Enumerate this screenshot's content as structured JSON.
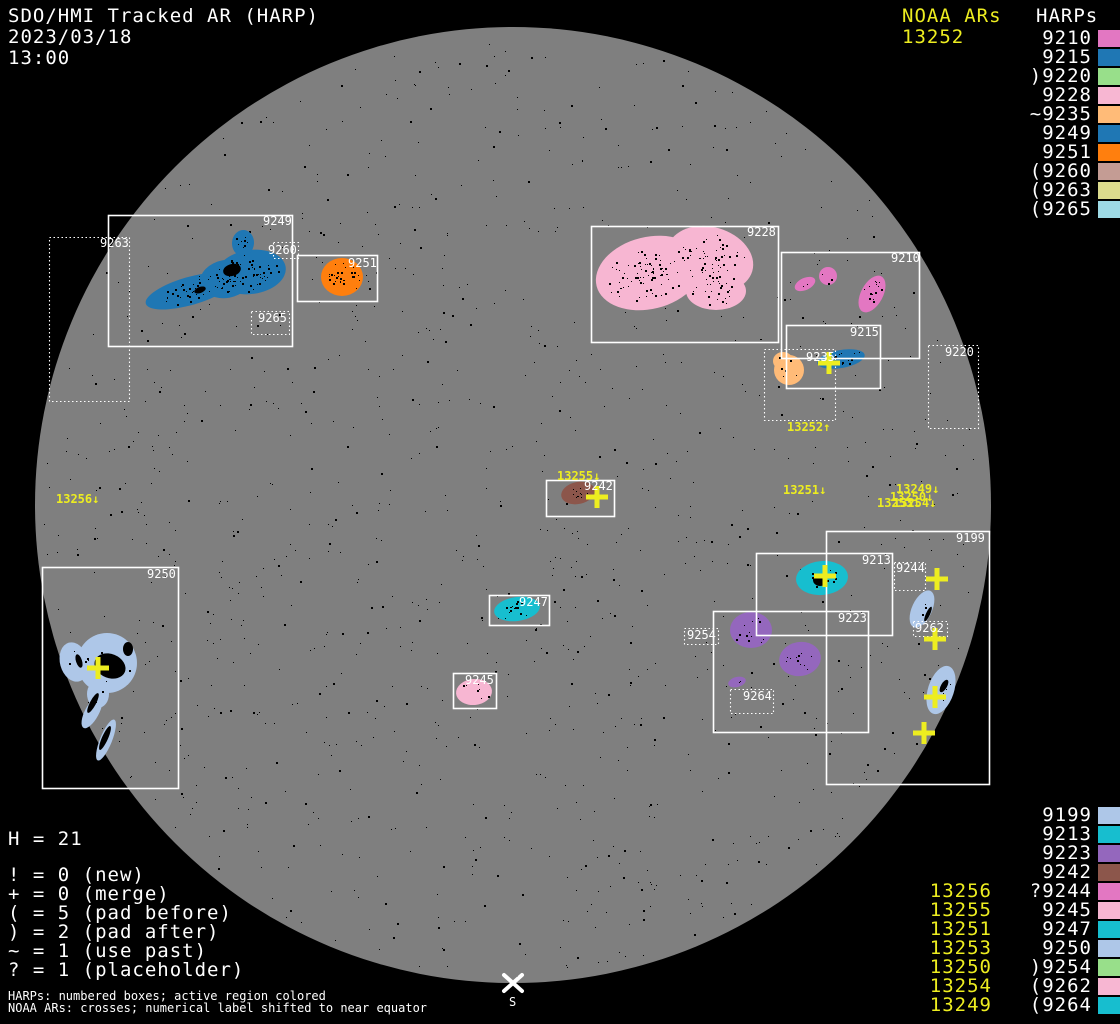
{
  "chart_data": {
    "type": "scatter",
    "title": "SDO/HMI Tracked AR (HARP)",
    "date": "2023/03/18",
    "time": "13:00",
    "noaa_header": "NOAA ARs",
    "noaa_current": "13252",
    "harps_header": "HARPs",
    "colors": {
      "background": "#000000",
      "disk": "#7f7f7f",
      "box_line": "#ffffff",
      "yellow": "#eded20"
    },
    "disk": {
      "cx": 513,
      "cy": 505,
      "r": 478
    },
    "legend_top": [
      {
        "text": "9210",
        "color": "#e377c2"
      },
      {
        "text": "9215",
        "color": "#1f77b4"
      },
      {
        "text": ")9220",
        "color": "#98df8a"
      },
      {
        "text": "9228",
        "color": "#f7b6d2"
      },
      {
        "text": "~9235",
        "color": "#ffbb78"
      },
      {
        "text": "9249",
        "color": "#1f77b4"
      },
      {
        "text": "9251",
        "color": "#ff7f0e"
      },
      {
        "text": "(9260",
        "color": "#c49c94"
      },
      {
        "text": "(9263",
        "color": "#dbdb8d"
      },
      {
        "text": "(9265",
        "color": "#9edae5"
      }
    ],
    "legend_bottom": [
      {
        "text": "9199",
        "color": "#aec7e8"
      },
      {
        "text": "9213",
        "color": "#17becf"
      },
      {
        "text": "9223",
        "color": "#9467bd"
      },
      {
        "text": "9242",
        "color": "#8c564b"
      },
      {
        "text": "?9244",
        "color": "#e377c2"
      },
      {
        "text": "9245",
        "color": "#f7b6d2"
      },
      {
        "text": "9247",
        "color": "#17becf"
      },
      {
        "text": "9250",
        "color": "#aec7e8"
      },
      {
        "text": ")9254",
        "color": "#98df8a"
      },
      {
        "text": "(9262",
        "color": "#f7b6d2"
      },
      {
        "text": "(9264",
        "color": "#17becf"
      }
    ],
    "noaa_bottom": [
      "13256",
      "13255",
      "13251",
      "13253",
      "13250",
      "13254",
      "13249"
    ],
    "stats": {
      "header": "H = 21",
      "lines": [
        "! = 0 (new)",
        "+ = 0 (merge)",
        "( = 5 (pad before)",
        ") = 2 (pad after)",
        "~ = 1 (use past)",
        "? = 1 (placeholder)"
      ]
    },
    "footnotes": [
      "HARPs: numbered boxes; active region colored",
      "NOAA ARs: crosses; numerical label shifted to near equator"
    ],
    "south_marker": {
      "symbol": "X",
      "label": "S",
      "x": 513,
      "y": 983
    },
    "boxes": [
      {
        "id": "9249",
        "x": 108,
        "y": 215,
        "w": 184,
        "h": 131,
        "style": "solid",
        "lx": 263,
        "ly": 215
      },
      {
        "id": "9263",
        "x": 49,
        "y": 237,
        "w": 80,
        "h": 164,
        "style": "dotted",
        "lx": 100,
        "ly": 237
      },
      {
        "id": "9260",
        "x": 273,
        "y": 242,
        "w": 25,
        "h": 16,
        "style": "dotted",
        "lx": 268,
        "ly": 244
      },
      {
        "id": "9251",
        "x": 297,
        "y": 255,
        "w": 80,
        "h": 46,
        "style": "solid",
        "lx": 348,
        "ly": 257
      },
      {
        "id": "9265",
        "x": 251,
        "y": 311,
        "w": 38,
        "h": 23,
        "style": "dotted",
        "lx": 258,
        "ly": 312
      },
      {
        "id": "9228",
        "x": 591,
        "y": 226,
        "w": 187,
        "h": 116,
        "style": "solid",
        "lx": 747,
        "ly": 226
      },
      {
        "id": "9210",
        "x": 781,
        "y": 252,
        "w": 138,
        "h": 106,
        "style": "solid",
        "lx": 891,
        "ly": 252
      },
      {
        "id": "9215",
        "x": 786,
        "y": 325,
        "w": 94,
        "h": 63,
        "style": "solid",
        "lx": 850,
        "ly": 326
      },
      {
        "id": "9235",
        "x": 764,
        "y": 349,
        "w": 71,
        "h": 71,
        "style": "dotted",
        "lx": 806,
        "ly": 351
      },
      {
        "id": "9220",
        "x": 928,
        "y": 345,
        "w": 50,
        "h": 83,
        "style": "dotted",
        "lx": 945,
        "ly": 346
      },
      {
        "id": "9242",
        "x": 546,
        "y": 480,
        "w": 68,
        "h": 36,
        "style": "solid",
        "lx": 584,
        "ly": 480
      },
      {
        "id": "9213",
        "x": 756,
        "y": 553,
        "w": 136,
        "h": 82,
        "style": "solid",
        "lx": 862,
        "ly": 554
      },
      {
        "id": "9244",
        "x": 894,
        "y": 562,
        "w": 31,
        "h": 28,
        "style": "dotted",
        "lx": 896,
        "ly": 562
      },
      {
        "id": "9262",
        "x": 913,
        "y": 621,
        "w": 34,
        "h": 15,
        "style": "dotted",
        "lx": 915,
        "ly": 622
      },
      {
        "id": "9223",
        "x": 713,
        "y": 611,
        "w": 155,
        "h": 121,
        "style": "solid",
        "lx": 838,
        "ly": 612
      },
      {
        "id": "9254",
        "x": 684,
        "y": 628,
        "w": 34,
        "h": 16,
        "style": "dotted",
        "lx": 687,
        "ly": 629
      },
      {
        "id": "9264",
        "x": 730,
        "y": 689,
        "w": 43,
        "h": 24,
        "style": "dotted",
        "lx": 743,
        "ly": 690
      },
      {
        "id": "9247",
        "x": 489,
        "y": 595,
        "w": 60,
        "h": 30,
        "style": "solid",
        "lx": 519,
        "ly": 596
      },
      {
        "id": "9245",
        "x": 453,
        "y": 673,
        "w": 43,
        "h": 35,
        "style": "solid",
        "lx": 465,
        "ly": 674
      },
      {
        "id": "9250",
        "x": 42,
        "y": 567,
        "w": 136,
        "h": 221,
        "style": "solid",
        "lx": 147,
        "ly": 568
      },
      {
        "id": "9199",
        "x": 826,
        "y": 531,
        "w": 163,
        "h": 253,
        "style": "solid",
        "lx": 956,
        "ly": 532
      }
    ],
    "crosses": [
      {
        "x": 829,
        "y": 363
      },
      {
        "x": 597,
        "y": 497
      },
      {
        "x": 825,
        "y": 576
      },
      {
        "x": 937,
        "y": 579
      },
      {
        "x": 935,
        "y": 639
      },
      {
        "x": 98,
        "y": 668
      },
      {
        "x": 935,
        "y": 697
      },
      {
        "x": 924,
        "y": 733
      }
    ],
    "ar_labels": [
      {
        "text": "13252↑",
        "x": 787,
        "y": 421
      },
      {
        "text": "13255↓",
        "x": 557,
        "y": 470
      },
      {
        "text": "13256↓",
        "x": 56,
        "y": 493
      },
      {
        "text": "13251↓",
        "x": 783,
        "y": 484
      },
      {
        "text": "13249↓",
        "x": 896,
        "y": 483
      },
      {
        "text": "13250↓",
        "x": 890,
        "y": 491
      },
      {
        "text": "13253↓",
        "x": 877,
        "y": 497
      },
      {
        "text": "13254↓",
        "x": 893,
        "y": 497
      }
    ],
    "blobs": [
      {
        "harp": "9249",
        "color": "#1f77b4",
        "speck": 120,
        "shapes": [
          [
            190,
            291,
            46,
            14,
            -16
          ],
          [
            226,
            279,
            26,
            19,
            -10
          ],
          [
            251,
            272,
            35,
            22,
            -8
          ],
          [
            243,
            243,
            11,
            13,
            5
          ]
        ],
        "spots": [
          [
            232,
            270,
            9,
            6,
            -15
          ],
          [
            200,
            290,
            6,
            3,
            -20
          ]
        ]
      },
      {
        "harp": "9251",
        "color": "#ff7f0e",
        "speck": 30,
        "shapes": [
          [
            342,
            277,
            21,
            19,
            0
          ]
        ],
        "spots": []
      },
      {
        "harp": "9228",
        "color": "#f7b6d2",
        "speck": 170,
        "shapes": [
          [
            649,
            273,
            54,
            36,
            -14
          ],
          [
            710,
            259,
            44,
            32,
            16
          ],
          [
            716,
            291,
            30,
            19,
            0
          ]
        ],
        "spots": []
      },
      {
        "harp": "9210",
        "color": "#e377c2",
        "speck": 24,
        "shapes": [
          [
            805,
            284,
            11,
            6,
            -25
          ],
          [
            828,
            276,
            9,
            9,
            0
          ],
          [
            872,
            294,
            11,
            20,
            28
          ]
        ],
        "spots": []
      },
      {
        "harp": "9215",
        "color": "#1f77b4",
        "speck": 14,
        "shapes": [
          [
            841,
            359,
            24,
            9,
            -10
          ]
        ],
        "spots": []
      },
      {
        "harp": "9235",
        "color": "#ffbb78",
        "speck": 8,
        "shapes": [
          [
            789,
            370,
            15,
            15,
            0
          ],
          [
            783,
            361,
            10,
            9,
            0
          ]
        ],
        "spots": []
      },
      {
        "harp": "9242",
        "color": "#8c564b",
        "speck": 12,
        "shapes": [
          [
            578,
            493,
            17,
            11,
            -12
          ]
        ],
        "spots": []
      },
      {
        "harp": "9213",
        "color": "#17becf",
        "speck": 10,
        "shapes": [
          [
            822,
            578,
            26,
            17,
            -5
          ]
        ],
        "spots": [
          [
            820,
            580,
            7,
            6,
            0
          ]
        ]
      },
      {
        "harp": "9223",
        "color": "#9467bd",
        "speck": 28,
        "shapes": [
          [
            751,
            630,
            21,
            18,
            0
          ],
          [
            800,
            659,
            21,
            17,
            -10
          ],
          [
            737,
            682,
            9,
            5,
            -15
          ]
        ],
        "spots": []
      },
      {
        "harp": "9199",
        "color": "#aec7e8",
        "speck": 10,
        "shapes": [
          [
            922,
            609,
            10,
            20,
            25
          ],
          [
            941,
            690,
            13,
            25,
            18
          ]
        ],
        "spots": [
          [
            928,
            614,
            2,
            8,
            25
          ],
          [
            944,
            686,
            3,
            7,
            30
          ]
        ]
      },
      {
        "harp": "9250",
        "color": "#aec7e8",
        "speck": 14,
        "shapes": [
          [
            107,
            663,
            30,
            30,
            0
          ],
          [
            74,
            662,
            14,
            20,
            -15
          ],
          [
            98,
            694,
            11,
            14,
            0
          ],
          [
            92,
            712,
            7,
            18,
            28
          ],
          [
            106,
            740,
            6,
            22,
            22
          ]
        ],
        "spots": [
          [
            110,
            666,
            16,
            12,
            22
          ],
          [
            128,
            649,
            5,
            7,
            0
          ],
          [
            93,
            703,
            3,
            11,
            28
          ],
          [
            105,
            738,
            3,
            13,
            24
          ],
          [
            79,
            661,
            3,
            7,
            -18
          ]
        ]
      },
      {
        "harp": "9247",
        "color": "#17becf",
        "speck": 16,
        "shapes": [
          [
            517,
            609,
            23,
            12,
            -8
          ]
        ],
        "spots": []
      },
      {
        "harp": "9245",
        "color": "#f7b6d2",
        "speck": 7,
        "shapes": [
          [
            474,
            692,
            18,
            13,
            -5
          ]
        ],
        "spots": []
      }
    ]
  }
}
